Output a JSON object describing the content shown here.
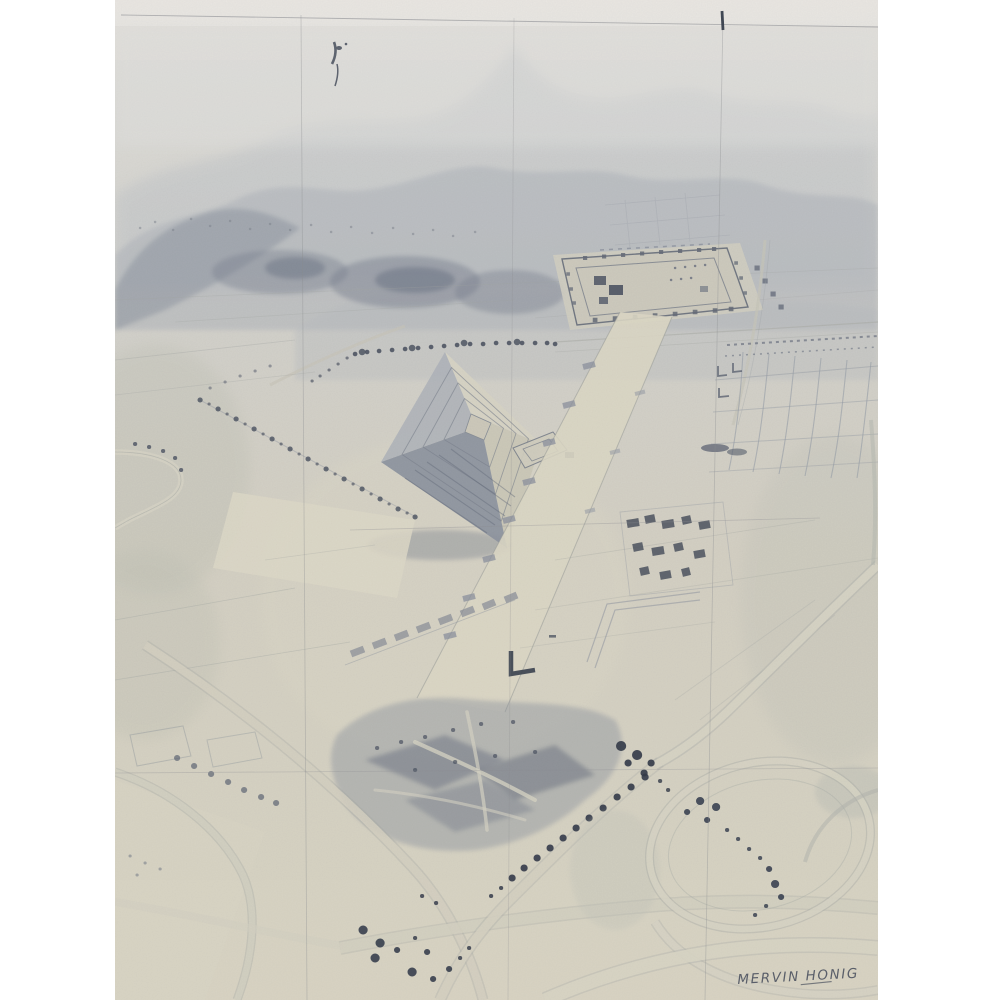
{
  "window": {
    "width": 1000,
    "height": 1000
  },
  "artwork": {
    "medium_label": "graphite pencil drawing, photographed",
    "signature": "MERVIN HONIG",
    "palette": {
      "margin": "#ffffff",
      "paper_top": "#e3e2de",
      "paper_mid": "#d4d3ce",
      "paper": "#d6d2c6",
      "paper_warm": "#dad6c5",
      "sky_haze": "#eceae6",
      "mtn_haze": "#c2c6cb",
      "mtn_mid": "#aeb3bb",
      "ridge_dark": "#8e95a1",
      "pencil_light": "#a9ada8",
      "pencil_mid": "#80868f",
      "pencil_dark": "#454c5a",
      "tree_dark": "#39404f",
      "grid_line": "#8e9094",
      "sig_ink": "#5c616c",
      "avenue": "#ded9c8",
      "wash_olive": "#bfc1b5"
    },
    "depicted_features": [
      "hazy mountain range along the top",
      "faint construction grid lines ruled over the sheet",
      "square walled citadel compound with perimeter mounds",
      "large stepped pyramid with shaded south-west faces",
      "broad ceremonial avenue lined with platform mounds",
      "sketched grid of ruined compounds at right",
      "cluster of small dark buildings beside the avenue",
      "patchwork farm fields, hedgerows and tree lines",
      "dark terraced hillside fields lower centre",
      "curving highway interchange loops at lower right",
      "scattered dark trees",
      "artist signature lower right"
    ]
  }
}
